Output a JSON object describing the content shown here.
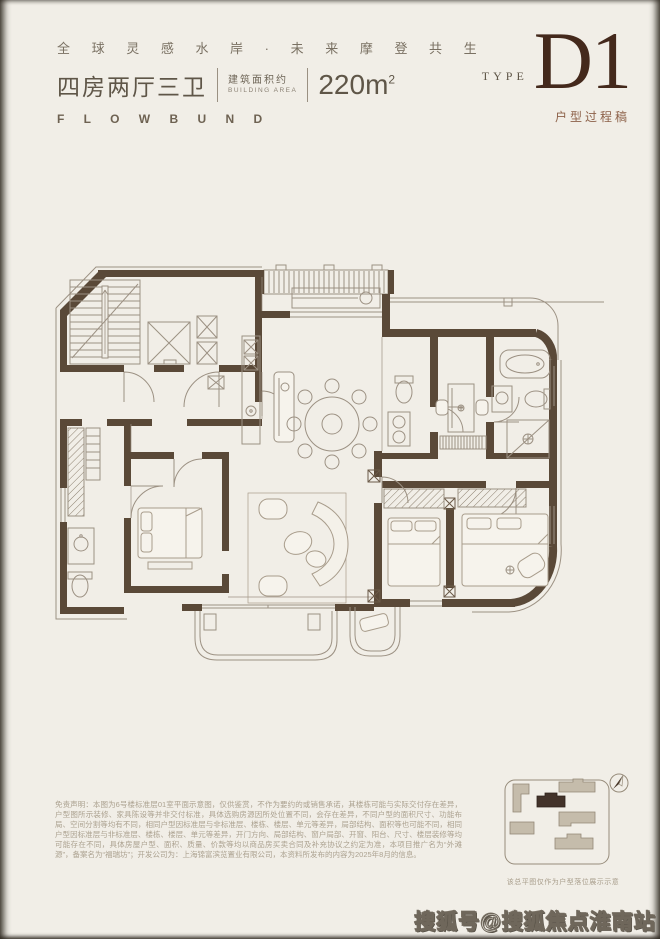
{
  "header": {
    "slogan": "全 球 灵 感 水 岸 · 未 来 摩 登 共 生",
    "unit_title": "四房两厅三卫",
    "area_label_cn": "建筑面积约",
    "area_label_en": "BUILDING AREA",
    "area_value": "220m",
    "area_sup": "2",
    "brand": "F L O W B U N D"
  },
  "type_block": {
    "type_label": "TYPE",
    "type_code": "D1",
    "type_note": "户型过程稿"
  },
  "floor_plan": {
    "description": "four-bedroom two-hall three-bath apartment floor plan",
    "rooms": [
      "楼梯间",
      "电梯",
      "玄关",
      "厨房",
      "餐厅",
      "客厅",
      "卧室",
      "卧室",
      "卧室",
      "主卧",
      "书房",
      "卫生间",
      "卫生间",
      "主卫",
      "阳台"
    ]
  },
  "disclaimer": {
    "text": "免责声明：本图为6号楼标准层01室平面示意图，仅供鉴赏，不作为要约的或销售承诺，其楼栋可能与实际交付存在差异，户型图所示装修、家具陈设等并非交付标准，具体选购房源因所处位置不同，会存在差异，不同户型的面积尺寸、功能布局、空间分割等均有不同，相同户型因标准层与非标准层、楼栋、楼层、单元等差异，局部结构、面积等也可能不同，相同户型因标准层与非标准层、楼栋、楼层、单元等差异，开门方向、局部结构、窗户局部、开窗、阳台、尺寸、楼层装修等均可能存在不同，具体房屋户型、面积、质量、价款等均以商品房买卖合同及补充协议之约定为准，本项目推广名为“外滩源”，备案名为“福瑞坊”；开发公司为：上海锦富滨览置业有限公司，本资料所发布的内容为2025年8月的信息。"
  },
  "siteplan": {
    "caption": "该总平图仅作为户型落位展示示意"
  },
  "watermark": {
    "text": "搜狐号@搜狐焦点淮南站"
  },
  "colors": {
    "background": "#f1eee7",
    "wall": "#5a4938",
    "thin_line": "#9c9183",
    "brand_dark": "#44291c",
    "type_note": "#8d6149",
    "disclaimer_text": "#aca290"
  }
}
